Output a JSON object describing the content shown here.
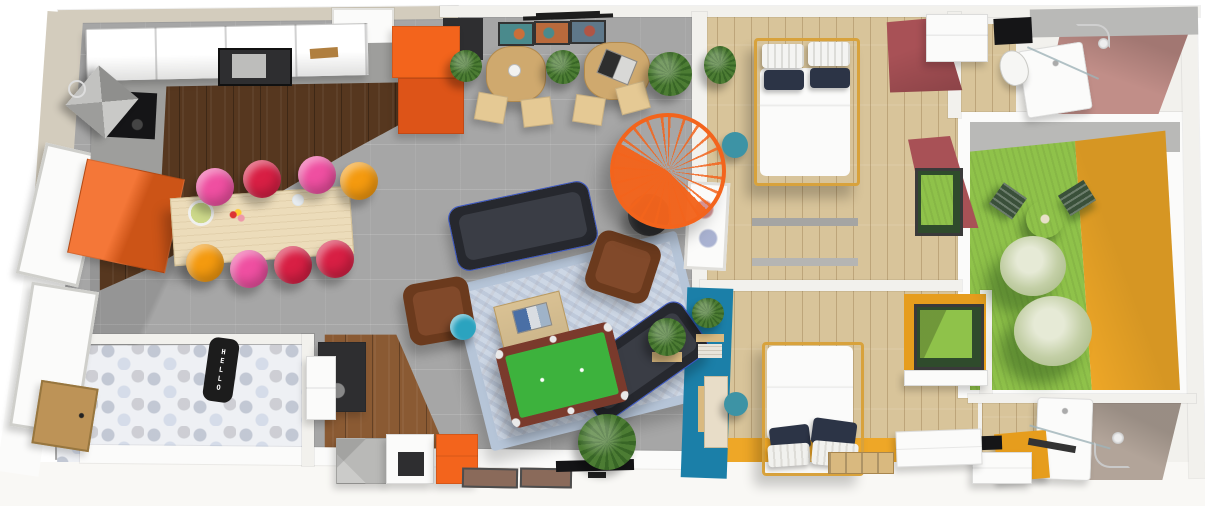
{
  "scene": {
    "type": "3d-floorplan-top-view",
    "rooms": [
      {
        "name": "kitchen",
        "floor": "dark-walnut-planks"
      },
      {
        "name": "dining-area",
        "floor": "gray-tile"
      },
      {
        "name": "cafe-corner",
        "floor": "gray-tile"
      },
      {
        "name": "living-room",
        "floor": "gray-tile"
      },
      {
        "name": "entry-hall",
        "floor": "hex-cement-tile"
      },
      {
        "name": "utility-corner",
        "floor": "mid-oak-planks"
      },
      {
        "name": "bedroom-1",
        "floor": "light-oak-planks"
      },
      {
        "name": "bathroom-1",
        "floor": "light-oak-planks"
      },
      {
        "name": "courtyard-patio",
        "floor": "grass"
      },
      {
        "name": "bedroom-2",
        "floor": "light-oak-planks"
      },
      {
        "name": "bathroom-2",
        "floor": "light-oak-planks"
      }
    ],
    "furniture": [
      "upper-cabinets",
      "range-hood",
      "cooktop",
      "sink-counter",
      "orange-tall-cabinet",
      "orange-base-cabinet",
      "dining-table",
      "bar-stools-x8",
      "cafe-table-x2",
      "cafe-chairs-x4",
      "wall-art-triptych",
      "track-light",
      "spiral-staircase",
      "pouf",
      "dark-sofa-x2",
      "brown-armchair-x2",
      "persian-rug",
      "coffee-table",
      "table-lamp",
      "pool-table",
      "tv",
      "picture-frames",
      "hello-doormat",
      "front-door",
      "laundry-unit",
      "storage-cubes",
      "double-bed-x2",
      "bedside-plant",
      "teal-stool-x2",
      "desk",
      "wardrobe",
      "shower-x2",
      "toilet",
      "bistro-table",
      "bistro-chairs-x2",
      "patio-trees",
      "shelf-wall-petrol",
      "dresser",
      "bench-crates"
    ]
  },
  "labels": {
    "doormat_text": "HELLO"
  },
  "palette": {
    "white": "#fbfbfa",
    "white_soft": "#f2f1ed",
    "outer": "#f9f8f5",
    "wall": "#f2f1ed",
    "wall_beige": "#d3ccbd",
    "tile": "#a6a6a6",
    "wood_dark": "#56371f",
    "wood_mid": "#8a5a33",
    "wood_oak": "#d8c49a",
    "hex": "#eef0f4",
    "orange": "#f3641c",
    "orange_dark": "#dd5418",
    "red_wall": "#a85156",
    "mauve": "#c18e88",
    "taupe": "#b2a499",
    "petrol": "#1b7fa8",
    "grass": "#8fc24a",
    "yellow": "#eea727",
    "yellow_deep": "#e69d1d",
    "pool_rail": "#7a3a2c",
    "pool_green": "#3db23d",
    "sofa": "#26282e",
    "sofa_seat": "#3a3d45",
    "armchair": "#6b3a1d",
    "armchair_seat": "#81492a",
    "rug": "#cdd7e5",
    "dining_wood": "#ecdcba",
    "cafe_wood": "#cfa96e",
    "chair_wood": "#e5c994",
    "pink": "#ef4fa1",
    "red": "#d81f44",
    "orange_stool": "#f49a0f",
    "teal": "#3d93a5",
    "lamp_teal": "#2ba3bf",
    "navy": "#2c3446",
    "counter": "#9e9e9c",
    "appliance": "#b9b9b7",
    "dark": "#2e2e30",
    "black": "#151517",
    "plant": "#4c7c33",
    "bench": "#d9b97f",
    "door_wood": "#bd9357",
    "mat": "#1c1c1c",
    "frame_brown": "#8a6a5a",
    "court_wall_gray": "#b9b9b7",
    "art_teal": "#4a8a8c",
    "art_orange": "#b96a3c",
    "art_gray": "#5f788a"
  }
}
